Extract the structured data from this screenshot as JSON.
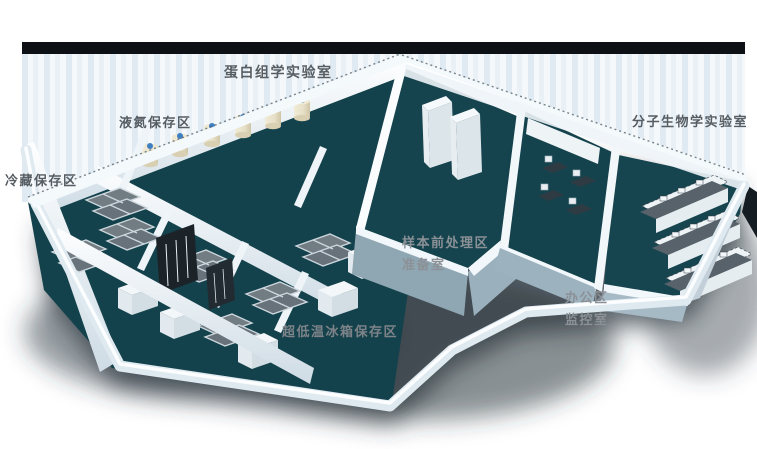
{
  "scene": {
    "description": "3D isometric rendering of an L-shaped biology laboratory suite with soft drop shadow on white background",
    "labels": [
      {
        "id": "proteomics-lab",
        "text": "蛋白组学实验室"
      },
      {
        "id": "liquid-nitrogen-area",
        "text": "液氮保存区"
      },
      {
        "id": "cold-storage-area",
        "text": "冷藏保存区"
      },
      {
        "id": "molecular-bio-lab",
        "text": "分子生物学实验室"
      },
      {
        "id": "sample-pretreat-area",
        "text": "样本前处理区"
      },
      {
        "id": "prep-room",
        "text": "准备室"
      },
      {
        "id": "office-area",
        "text": "办公区"
      },
      {
        "id": "monitor-room",
        "text": "监控室"
      },
      {
        "id": "ulf-freezer-area",
        "text": "超低温冰箱保存区"
      }
    ],
    "colors": {
      "background": "#ffffff",
      "roof_edge_dark": "#0d1115",
      "back_wall_stripe_light": "#f4f8fb",
      "back_wall_stripe_blue": "#dfeaf2",
      "wall_white": "#f1f7fa",
      "wall_shaded_bluegray": "#93a9b6",
      "floor_teal_dark": "#14424c",
      "floor_teal": "#17454f",
      "freezer_gray": "#6b767d",
      "dewar_body_cream": "#e9e2cc",
      "dewar_cap_blue": "#3f7fc1",
      "bench_top_gray": "#57626a",
      "shadow_gray": "#2d3840",
      "label_gray": "#565d63",
      "label_gray_on_shadow": "#8b9196"
    }
  }
}
